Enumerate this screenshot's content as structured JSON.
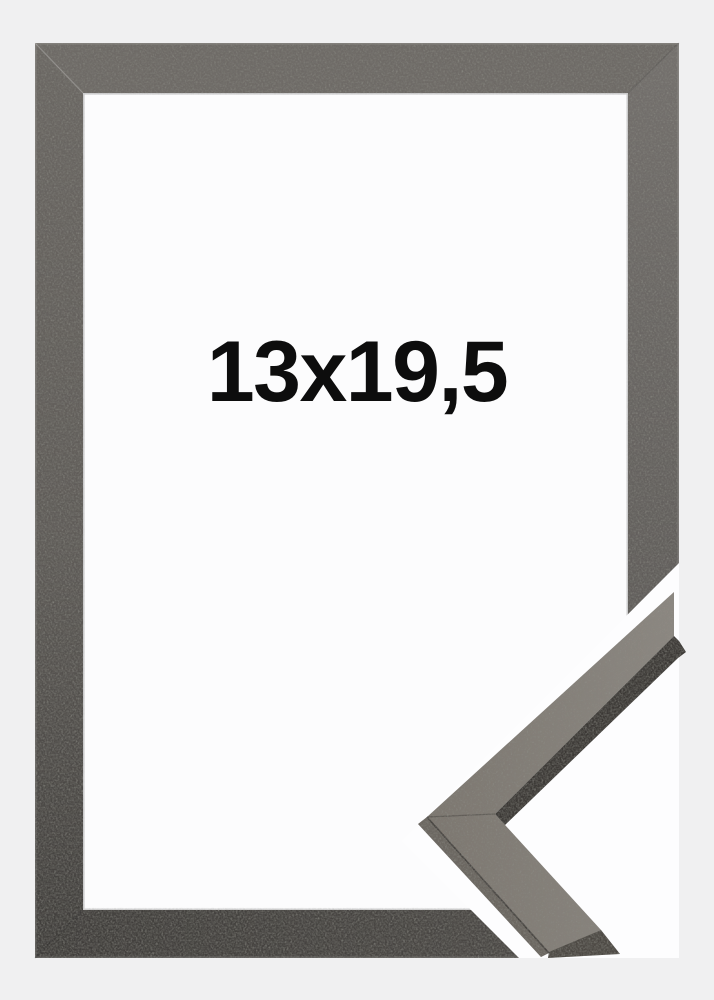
{
  "product": {
    "size_label": "13x19,5",
    "description": "picture frame with corner profile sample"
  },
  "colors": {
    "background": "#f0f0f1",
    "window_white": "#fcfcfd",
    "cut_white": "#fdfdfe",
    "label_text": "#0d0d0d",
    "frame_top": "#6e6a66",
    "frame_right": "#74706d",
    "frame_right_fix": "#74706d",
    "frame_left": "#6b6763",
    "frame_bottom": "#4e4b48",
    "sample_face": "#7d7770",
    "sample_side_dark": "#3b3835",
    "sample_side_light": "#6b6660",
    "sample_end_dark": "#4c4843"
  }
}
